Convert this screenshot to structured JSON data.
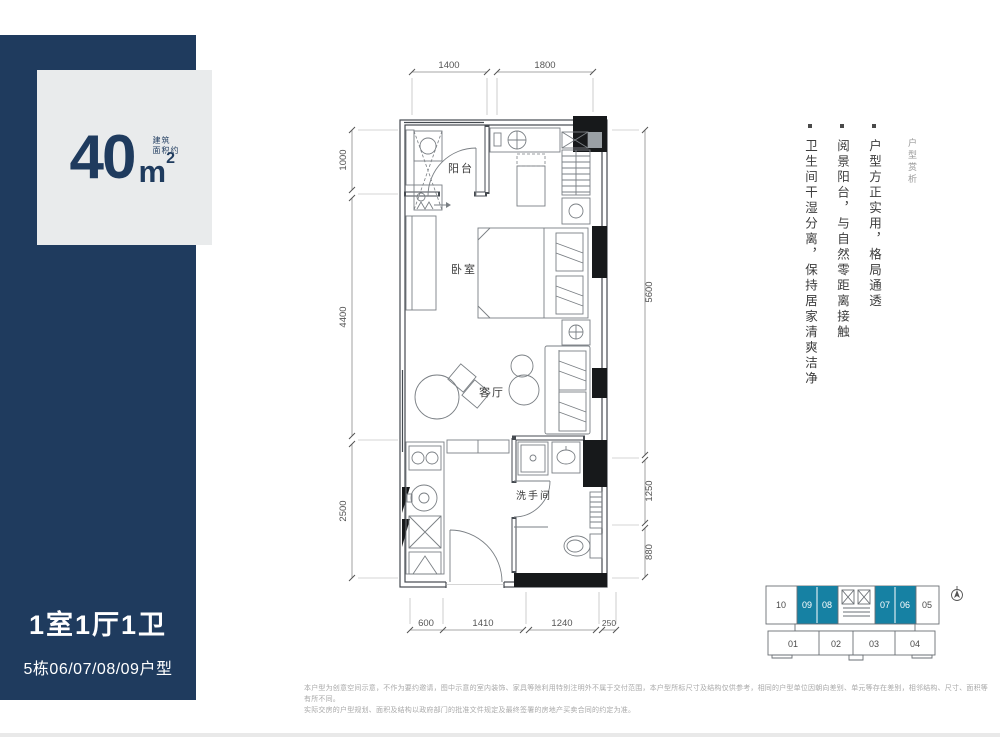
{
  "area_card": {
    "number": "40",
    "unit": "m",
    "sup": "2",
    "note_line1": "建筑",
    "note_line2": "面积约"
  },
  "unit_info": {
    "title": "1室1厅1卫",
    "subtitle": "5栋06/07/08/09户型"
  },
  "floorplan": {
    "rooms": {
      "balcony": "阳台",
      "bedroom": "卧室",
      "living": "客厅",
      "bathroom": "洗手间"
    },
    "dims": {
      "top": [
        "1400",
        "1800"
      ],
      "left": [
        "1000",
        "4400",
        "2500"
      ],
      "right": [
        "5600",
        "1250",
        "880"
      ],
      "bottom": [
        "600",
        "1410",
        "1240",
        "250"
      ]
    }
  },
  "analysis": {
    "label": "户型赏析",
    "points": [
      "户型方正实用，格局通透",
      "阅景阳台，与自然零距离接触",
      "卫生间干湿分离，保持居家清爽洁净"
    ]
  },
  "keyplan": {
    "top_units": [
      "10",
      "09",
      "08",
      "07",
      "06",
      "05"
    ],
    "bottom_units": [
      "01",
      "02",
      "03",
      "04"
    ],
    "highlighted_units": [
      "09",
      "08",
      "07",
      "06"
    ],
    "highlight_color": "#1681a3"
  },
  "disclaimer": {
    "line1": "本户型为创意空间示意，不作为要约邀请，图中示意的室内装饰、家具等除利用特别注明外不属于交付范围，本户型所标尺寸及结构仅供参考，相同的户型单位因朝向差别、单元等存在差别，相邻结构、尺寸、面积等有所不同。",
    "line2": "实际交房的户型规划、面积及结构以政府部门的批准文件规定及最终签署的房地产买卖合同的约定为准。"
  },
  "colors": {
    "navy": "#1f3b5e",
    "teal": "#1681a3",
    "card_bg": "#e9ebec"
  }
}
